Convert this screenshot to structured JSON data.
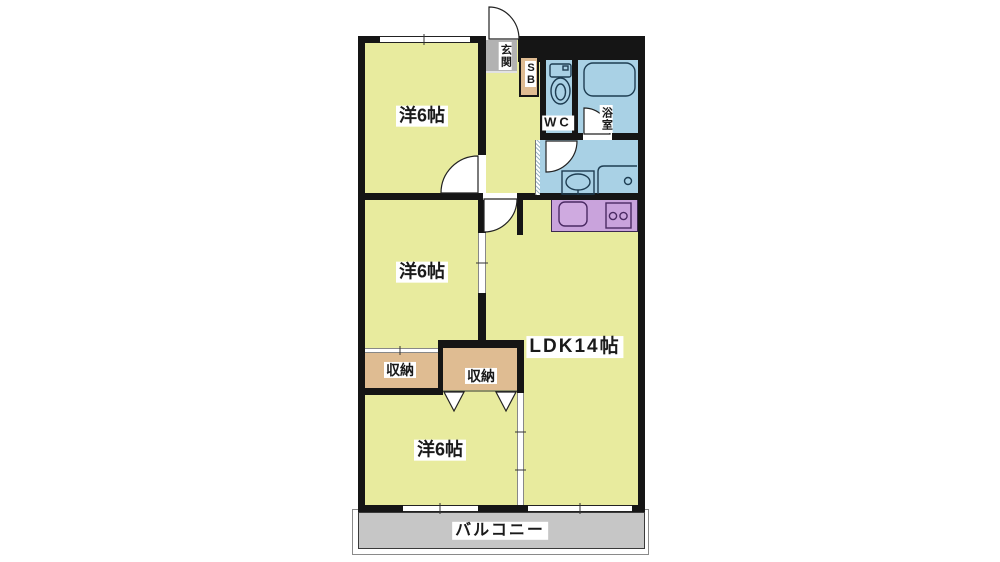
{
  "floor_plan": {
    "rooms": {
      "bedroom_top": {
        "label": "洋6帖"
      },
      "bedroom_middle": {
        "label": "洋6帖"
      },
      "bedroom_bottom": {
        "label": "洋6帖"
      },
      "ldk": {
        "label": "LDK14帖"
      },
      "storage_left": {
        "label": "収納"
      },
      "storage_right": {
        "label": "収納"
      },
      "entrance": {
        "label": "玄関"
      },
      "shoe_box": {
        "label": "SB"
      },
      "toilet": {
        "label": "WC"
      },
      "bathroom": {
        "label": "浴室"
      },
      "balcony": {
        "label": "バルコニー"
      }
    },
    "colors": {
      "room_floor": "#e8eb9e",
      "wet_area": "#a9d1e5",
      "kitchen_counter": "#c9a3dc",
      "storage_floor": "#dfbc92",
      "entrance_floor": "#b2b2b2",
      "balcony_floor": "#c6c6c6",
      "wall": "#151515",
      "label_background": "#ffffff"
    }
  }
}
